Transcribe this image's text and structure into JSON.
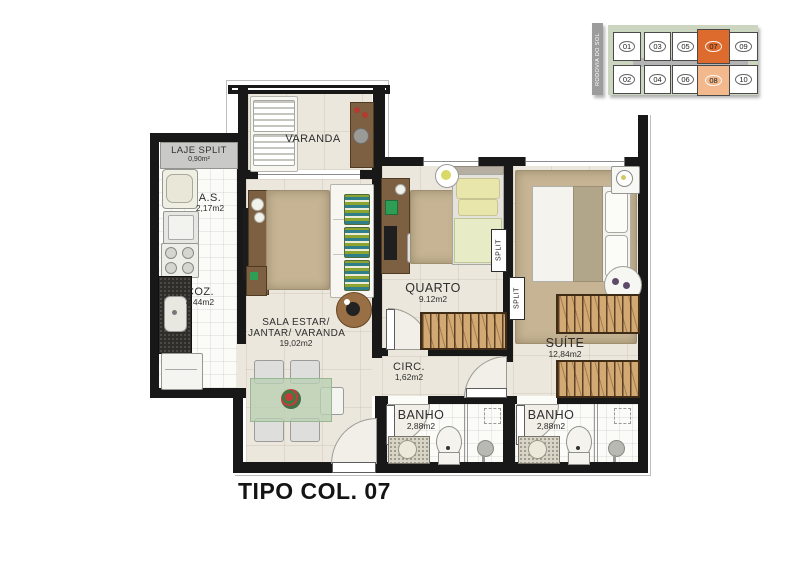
{
  "page": {
    "title": "TIPO COL. 07"
  },
  "keyplan": {
    "road_label": "RODOVIA DO SOL",
    "units_top": [
      "01",
      "03",
      "05",
      "07",
      "09"
    ],
    "units_bottom": [
      "02",
      "04",
      "06",
      "08",
      "10"
    ],
    "highlighted_unit": "07",
    "highlighted_unit_pair": "08",
    "colors": {
      "panel": "#cbd5c0",
      "road": "#9c9c9c",
      "corridor": "#b4b4b4",
      "unit": "#ffffff",
      "unit_border": "#4a4a4a",
      "highlight_strong": "#dd6b2e",
      "highlight_soft": "#f3b88c"
    }
  },
  "rooms": {
    "laje_split": {
      "name": "LAJE SPLIT",
      "area": "0,90m²"
    },
    "as": {
      "name": "A.S.",
      "area": "2,17m2"
    },
    "coz": {
      "name": "COZ.",
      "area": "4,44m2"
    },
    "varanda": {
      "name": "VARANDA"
    },
    "sala": {
      "name_line1": "SALA ESTAR/",
      "name_line2": "JANTAR/ VARANDA",
      "area": "19,02m2"
    },
    "quarto": {
      "name": "QUARTO",
      "area": "9.12m2"
    },
    "circ": {
      "name": "CIRC.",
      "area": "1,62m2"
    },
    "suite": {
      "name": "SUÍTE",
      "area": "12,84m2"
    },
    "banho1": {
      "name": "BANHO",
      "area": "2,88m2"
    },
    "banho2": {
      "name": "BANHO",
      "area": "2,88m2"
    }
  },
  "equipment": {
    "split_1": "SPLIT",
    "split_2": "SPLIT"
  }
}
